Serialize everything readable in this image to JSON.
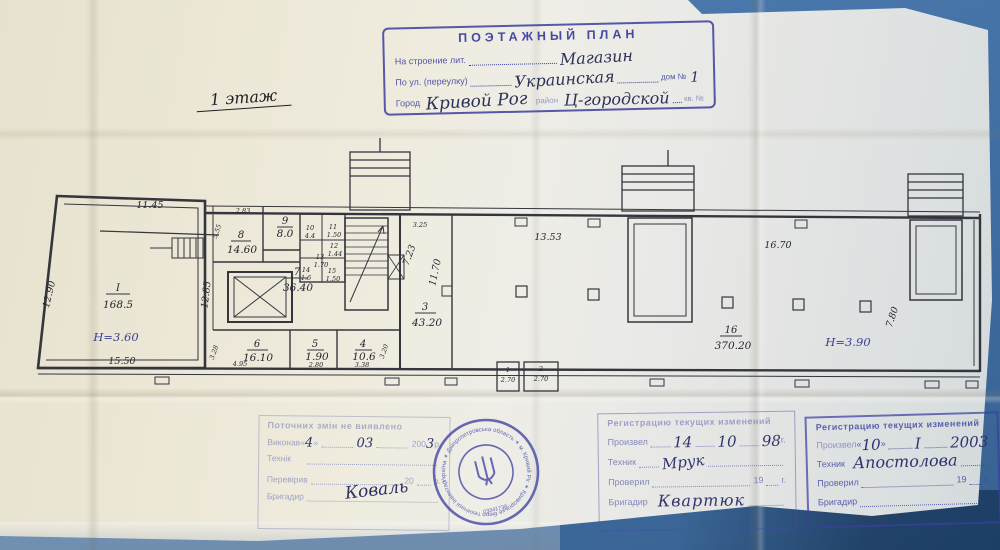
{
  "header_stamp": {
    "title": "ПОЭТАЖНЫЙ ПЛАН",
    "row1_label": "На строение лит.",
    "row1_value": "Магазин",
    "row2_label": "По ул. (переулку)",
    "row2_value": "Украинская",
    "row2_label2": "дом №",
    "row2_value2": "1",
    "row3_label": "Город",
    "row3_value": "Кривой Рог",
    "row3_label2": "район",
    "row3_value2": "Ц-городской",
    "row3_label3": "кв. №"
  },
  "floor_label": "1 этаж",
  "plan": {
    "rooms": {
      "rI": {
        "n": "I",
        "a": "168.5"
      },
      "r1": {
        "n": "1",
        "a": "2.70"
      },
      "r2": {
        "n": "2",
        "a": "2.70"
      },
      "r3": {
        "n": "3",
        "a": "43.20"
      },
      "r4": {
        "n": "4",
        "a": "10.6"
      },
      "r5": {
        "n": "5",
        "a": "1.90"
      },
      "r6": {
        "n": "6",
        "a": "16.10"
      },
      "r7": {
        "n": "7",
        "a": "36.40"
      },
      "r8": {
        "n": "8",
        "a": "14.60"
      },
      "r9": {
        "n": "9",
        "a": "8.0"
      },
      "r10": {
        "n": "10",
        "a": "4.4"
      },
      "r11": {
        "n": "11",
        "a": "1.50"
      },
      "r12": {
        "n": "12",
        "a": "1.44"
      },
      "r13": {
        "n": "13",
        "a": "1.70"
      },
      "r14": {
        "n": "14",
        "a": "1.6"
      },
      "r15": {
        "n": "15",
        "a": "1.50"
      },
      "r16": {
        "n": "16",
        "a": "370.20"
      }
    },
    "heights": {
      "left": "Н=3.60",
      "right": "Н=3.90"
    },
    "dims": {
      "d1145": "11.45",
      "d1290": "12.90",
      "d1550": "15.50",
      "d1285": "12.85",
      "d283": "2.83",
      "d555": "5.55",
      "d325": "3.25",
      "d723": "7.23",
      "d1170": "11.70",
      "d1353": "13.53",
      "d1670": "16.70",
      "d780": "7.80",
      "d495": "4.95",
      "d328": "3.28",
      "d280": "2.80",
      "d338": "3.38",
      "d320": "3.20"
    }
  },
  "stamp_left": {
    "title": "Поточних змін не виявлено",
    "row1_label": "Виконав",
    "q1": "«",
    "v1": "4",
    "q2": "»",
    "v2": "03",
    "year_prefix": "200",
    "v3": "3",
    "r1": "р.",
    "signature": "Коваль",
    "row2_label": "Технік",
    "row3_label": "Перевірив",
    "check_year": "20",
    "r3": "р.",
    "row4_label": "Бригадир"
  },
  "stamp_mid": {
    "title": "Регистрацию текущих изменений",
    "row1_label": "Произвел",
    "v1": "14",
    "v2": "10",
    "v3": "98",
    "r1": "г.",
    "row2_label": "Техник",
    "row2_value": "Мрук",
    "row3_label": "Проверил",
    "check_year": "19",
    "r3": "г.",
    "row4_label": "Бригадир",
    "row4_value": "Квартюк"
  },
  "stamp_right": {
    "title": "Регистрацию текущих изменений",
    "row1_label": "Произвел",
    "q1": "«",
    "v1": "10",
    "q2": "»",
    "v2": "І",
    "v3": "2003",
    "row2_label": "Техник",
    "row2_value": "Апостолова",
    "row3_label": "Проверил",
    "check_year": "19",
    "r3": "г.",
    "row4_label": "Бригадир"
  },
  "seal": {
    "ring_text": "Україна ✶ Дніпропетровська область ✶ м. Кривий Ріг ✶ Криворізьке бюро технічної інвентаризації",
    "code": "03341738"
  }
}
